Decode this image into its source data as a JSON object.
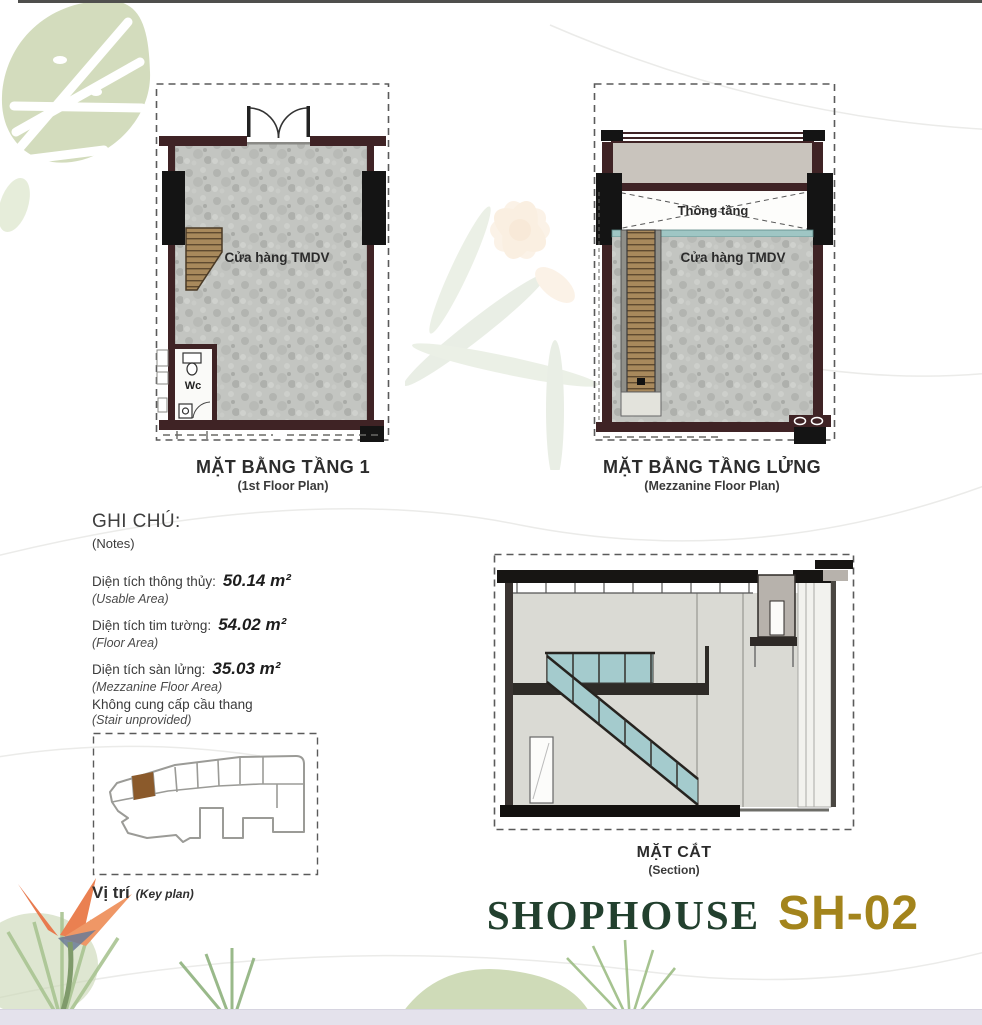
{
  "plan1": {
    "title": "MẶT BẰNG TẦNG 1",
    "subtitle": "(1st Floor Plan)",
    "room_label": "Cửa hàng TMDV",
    "wc_label": "Wc"
  },
  "plan2": {
    "title": "MẶT BẰNG TẦNG LỬNG",
    "subtitle": "(Mezzanine Floor Plan)",
    "void_label": "Thông tầng",
    "room_label": "Cửa hàng TMDV"
  },
  "notes": {
    "heading": "GHI CHÚ:",
    "heading_sub": "(Notes)",
    "items": [
      {
        "label": "Diện tích thông thủy:",
        "value": "50.14 m²",
        "sub": "(Usable Area)"
      },
      {
        "label": "Diện tích tim tường:",
        "value": "54.02 m²",
        "sub": "(Floor Area)"
      },
      {
        "label": "Diện tích sàn lửng:",
        "value": "35.03 m²",
        "sub": "(Mezzanine Floor Area)"
      }
    ],
    "extra_line": "Không cung cấp cầu thang",
    "extra_sub": "(Stair unprovided)"
  },
  "keyplan": {
    "label": "Vị trí",
    "label_sub": "(Key plan)",
    "highlight_color": "#8b5a2b"
  },
  "section": {
    "title": "MẶT CẮT",
    "subtitle": "(Section)"
  },
  "footer": {
    "title": "SHOPHOUSE",
    "unit": "SH-02",
    "title_color": "#22402e",
    "unit_color": "#a3841c"
  },
  "colors": {
    "wall": "#3f2325",
    "column": "#141414",
    "floor_gray": "#c3c5c1",
    "stair_wood": "#a8895c",
    "glass_teal": "#a4cbcd",
    "keyplan_highlight": "#8b5a2b",
    "footer_bar": "#e4e2ec"
  }
}
